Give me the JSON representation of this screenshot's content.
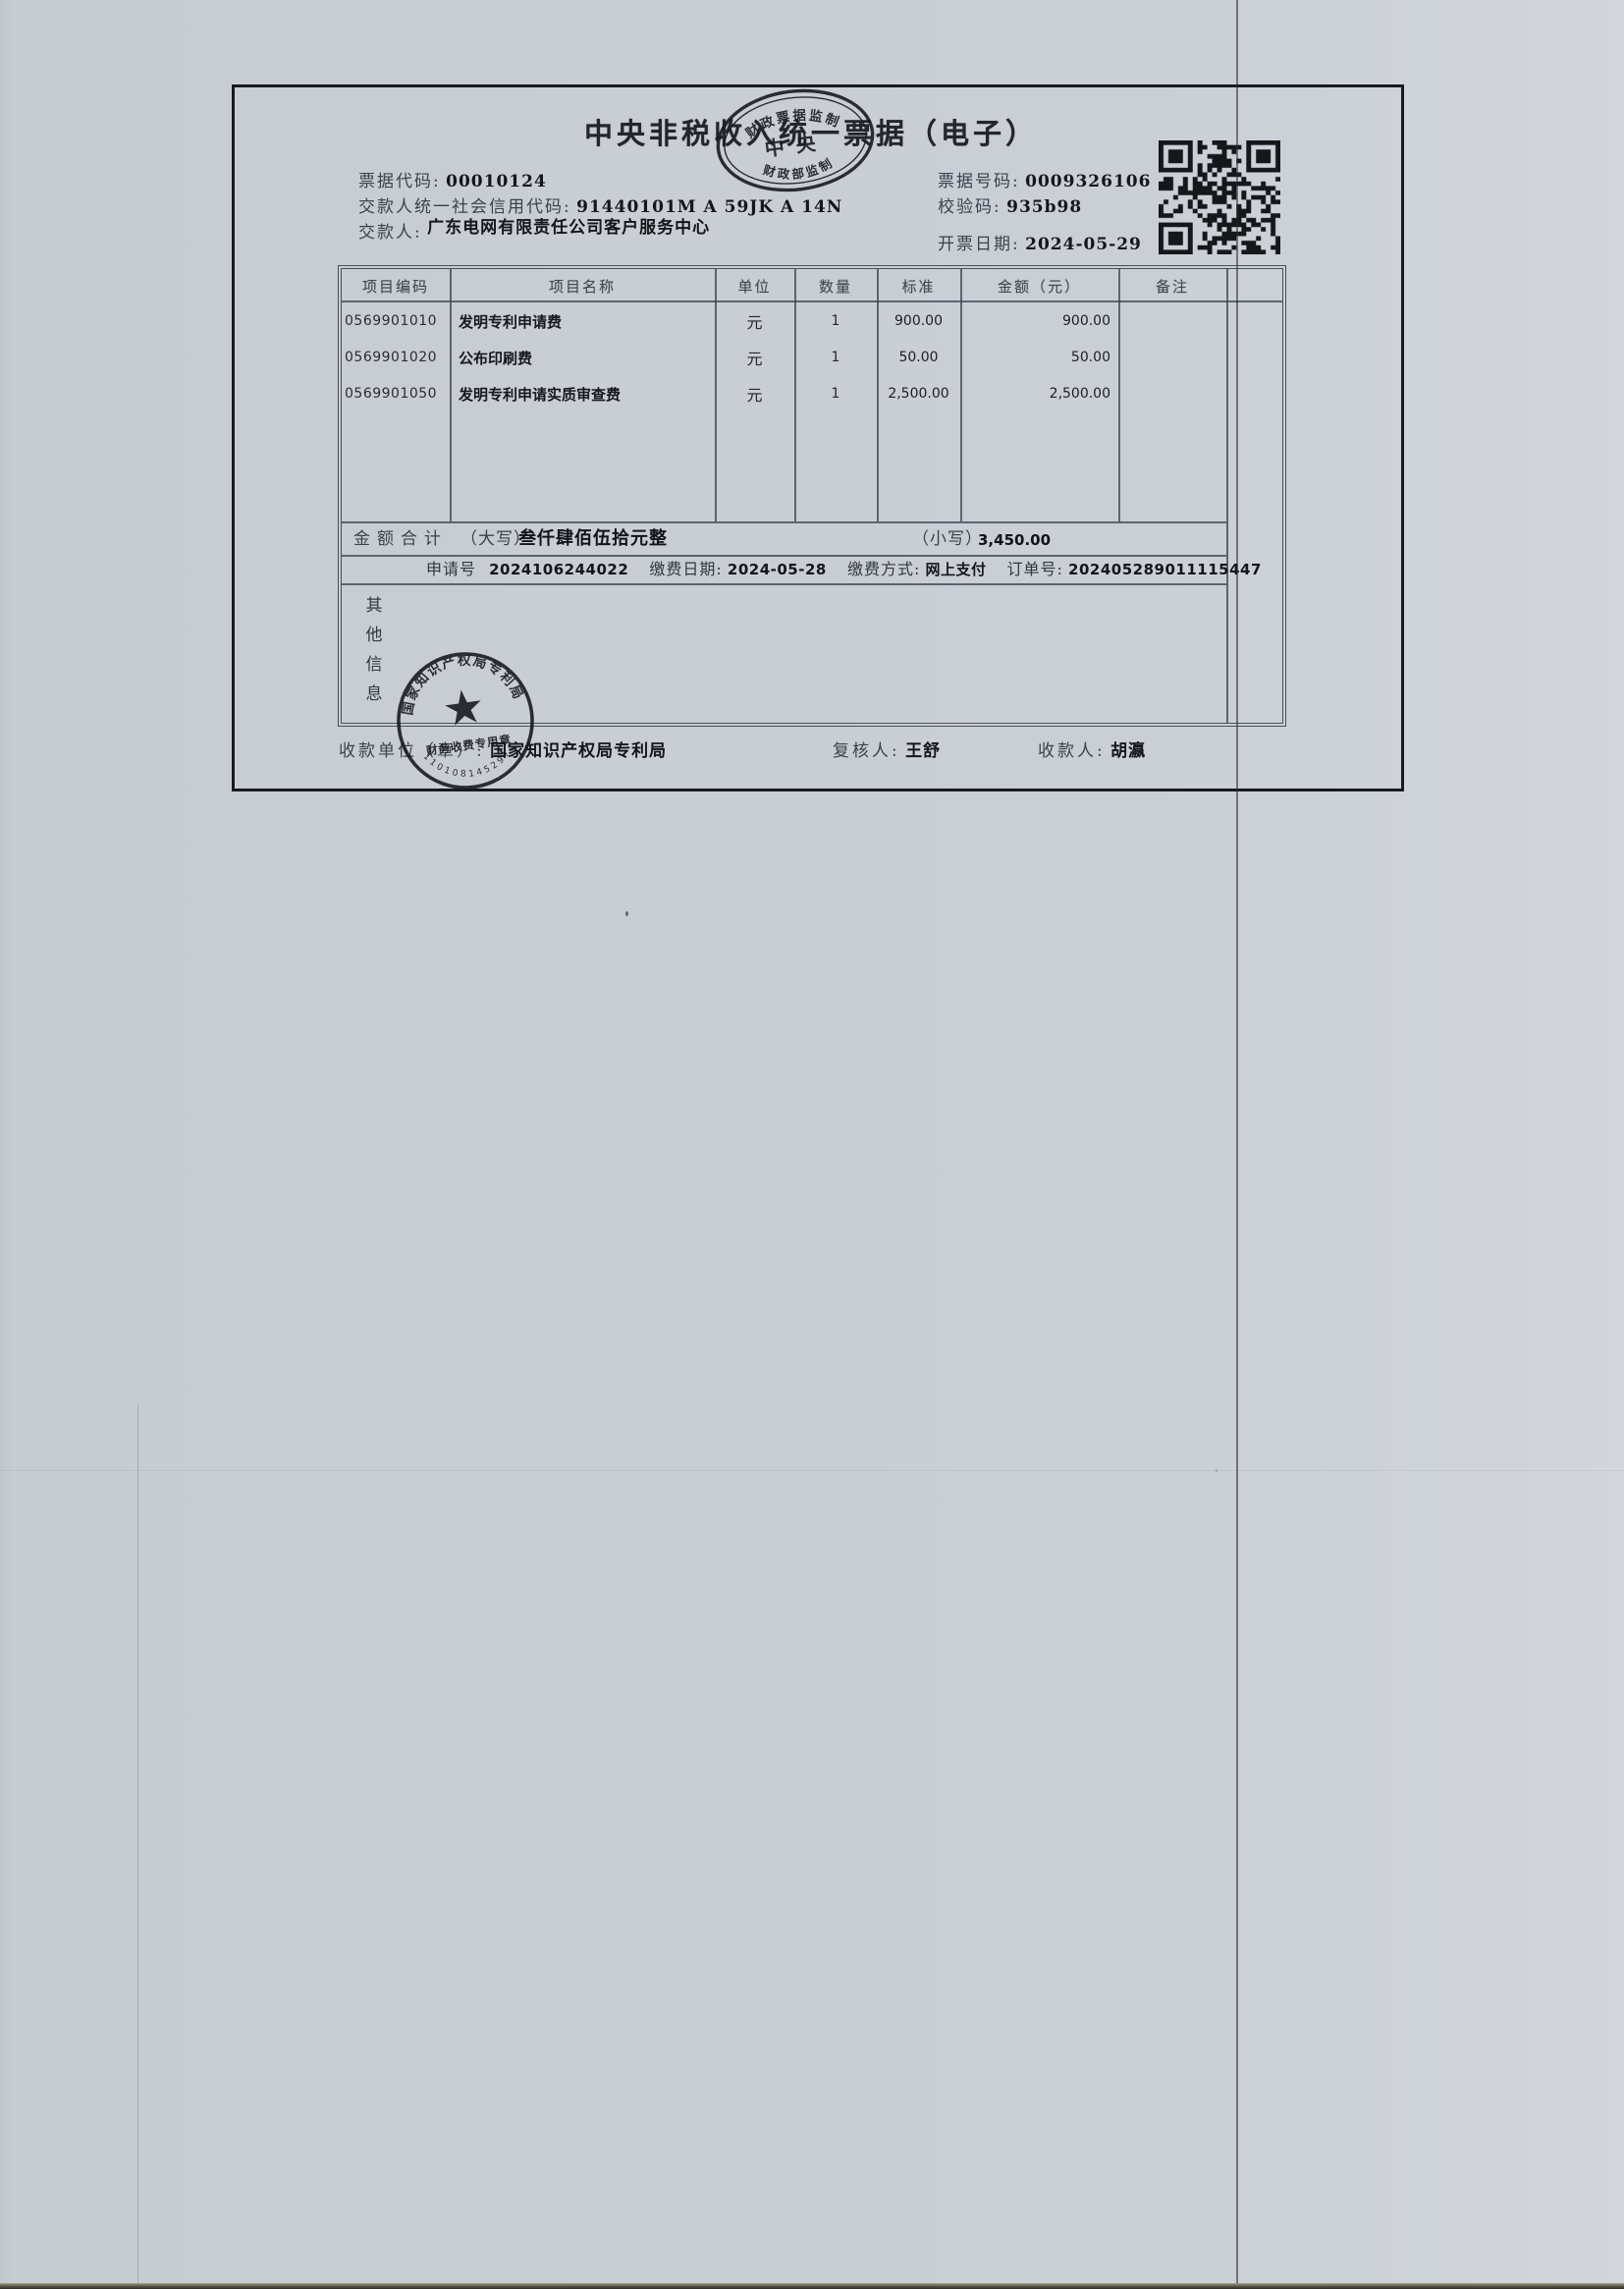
{
  "colors": {
    "paper": "#c9ced5",
    "ink": "#1d2025",
    "stamp_ink": "#181b20",
    "table_border": "#4a5058"
  },
  "receipt": {
    "title": "中央非税收入统一票据（电子）",
    "header": {
      "left": [
        {
          "label": "票据代码:",
          "value": "00010124"
        },
        {
          "label": "交款人统一社会信用代码:",
          "value": "91440101M A 59JK A 14N"
        },
        {
          "label": "交款人:",
          "value": "广东电网有限责任公司客户服务中心"
        }
      ],
      "right": [
        {
          "label": "票据号码:",
          "value": "0009326106"
        },
        {
          "label": "校验码:",
          "value": "935b98"
        },
        {
          "label": "开票日期:",
          "value": "2024-05-29"
        }
      ]
    },
    "supervision_stamp": {
      "arc_top": "财政票据监制",
      "center": "中央",
      "arc_bottom": "财政部监制"
    },
    "table": {
      "headers": [
        "项目编码",
        "项目名称",
        "单位",
        "数量",
        "标准",
        "金额（元）",
        "备注"
      ],
      "rows": [
        {
          "code": "0569901010",
          "name": "发明专利申请费",
          "unit": "元",
          "qty": "1",
          "std": "900.00",
          "amount": "900.00",
          "note": ""
        },
        {
          "code": "0569901020",
          "name": "公布印刷费",
          "unit": "元",
          "qty": "1",
          "std": "50.00",
          "amount": "50.00",
          "note": ""
        },
        {
          "code": "0569901050",
          "name": "发明专利申请实质审查费",
          "unit": "元",
          "qty": "1",
          "std": "2,500.00",
          "amount": "2,500.00",
          "note": ""
        }
      ],
      "total": {
        "label": "金额合计",
        "capital_label": "（大写）",
        "capital_value": "叁仟肆佰伍拾元整",
        "small_label": "（小写）",
        "small_value": "3,450.00"
      },
      "payment": {
        "segments": [
          {
            "label": "申请号",
            "value": "2024106244022"
          },
          {
            "label": "缴费日期:",
            "value": "2024-05-28"
          },
          {
            "label": "缴费方式:",
            "value": "网上支付"
          },
          {
            "label": "订单号:",
            "value": "202405289011115447"
          }
        ]
      },
      "other_info": {
        "chars": [
          "其",
          "他",
          "信",
          "息"
        ]
      }
    },
    "footer": {
      "payee_label": "收款单位（章）:",
      "payee_value": "国家知识产权局专利局",
      "reviewer_label": "复核人:",
      "reviewer_value": "王舒",
      "cashier_label": "收款人:",
      "cashier_value": "胡瀛"
    },
    "payee_seal": {
      "arc_top": "国家知识产权局专利局",
      "banner": "财务收费专用章",
      "digits": "1101081452974",
      "star": "★"
    }
  }
}
